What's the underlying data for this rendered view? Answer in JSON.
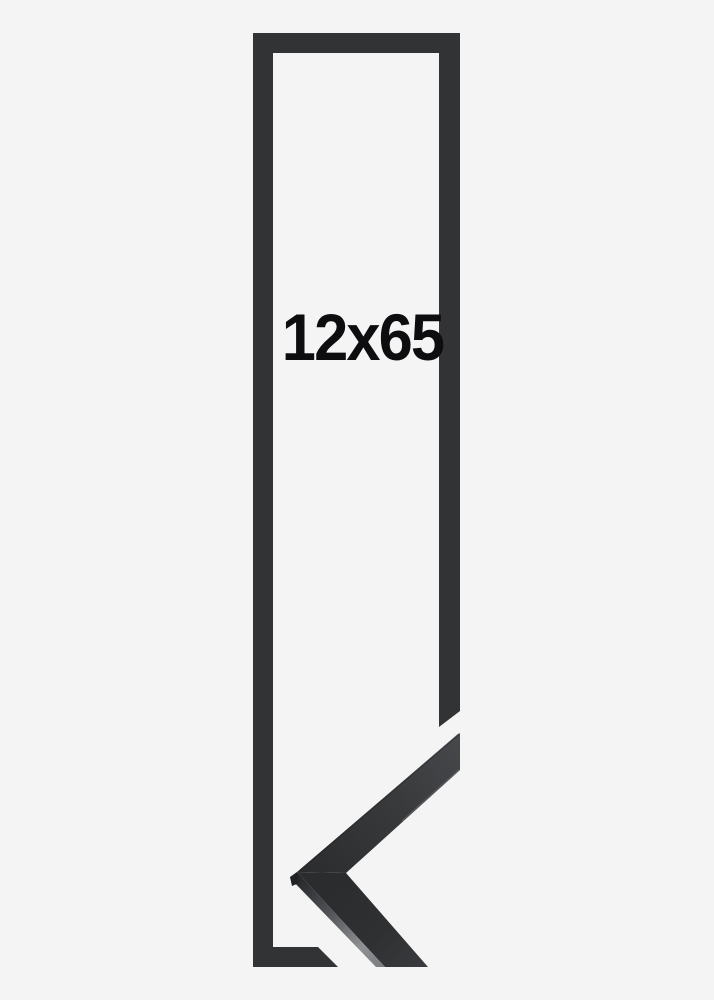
{
  "frame_preview": {
    "size_label": "12x65"
  },
  "colors": {
    "background": "#f4f4f4",
    "frame": "#323335",
    "label_text": "#0d0d0f",
    "corner_light": "#47484b",
    "corner_mid": "#37383a",
    "corner_dark": "#2b2c2e",
    "edge_highlight": "#909195",
    "edge_shadow": "#212224"
  }
}
